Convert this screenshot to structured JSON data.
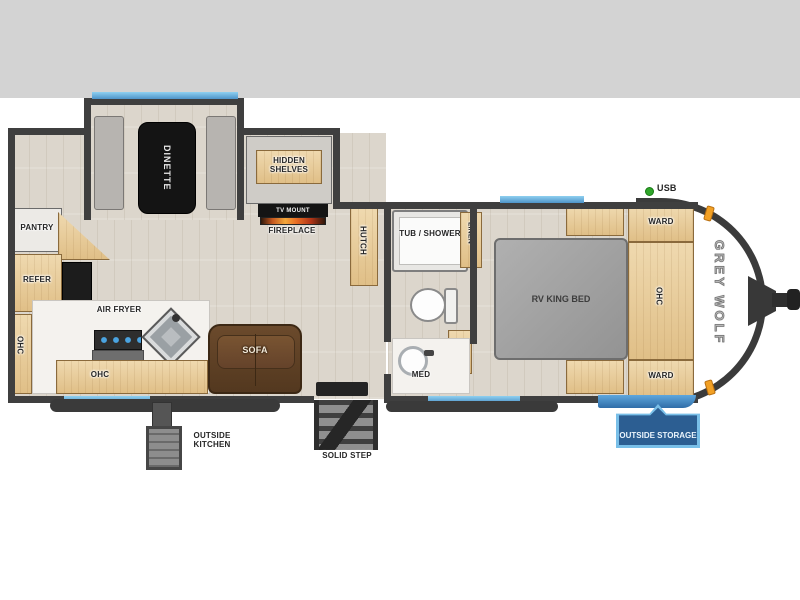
{
  "scene": {
    "type": "travel-trailer-floorplan",
    "brand": "GREY WOLF"
  },
  "labels": {
    "pantry": "PANTRY",
    "refer": "REFER",
    "ohc_left": "OHC",
    "air_fryer": "AIR FRYER",
    "ohc_counter": "OHC",
    "sofa": "SOFA",
    "dinette": "DINETTE",
    "hidden_shelves": "HIDDEN SHELVES",
    "tv_mount": "TV MOUNT",
    "fireplace": "FIREPLACE",
    "hutch": "HUTCH",
    "tub_shower": "TUB / SHOWER",
    "linen": "LINEN",
    "med": "MED",
    "rv_king_bed": "RV KING BED",
    "ward_top": "WARD",
    "ohc_bedroom": "OHC",
    "ward_bottom": "WARD",
    "usb": "USB",
    "brand": "GREY WOLF",
    "outside_kitchen": "OUTSIDE KITCHEN",
    "solid_step": "SOLID STEP",
    "outside_storage": "OUTSIDE STORAGE"
  },
  "colors": {
    "background_band": "#d3d3d3",
    "wall": "#3f3f3f",
    "accent_blue": "#74b9e4",
    "cabinet_wood": "#e8cf9f",
    "sofa_brown": "#5d4127",
    "bed_gray": "#a6a6a6",
    "badge_blue": "#2c5e92",
    "badge_border": "#79bfe8",
    "usb_green": "#2fa52a",
    "marker_orange": "#f2a024"
  }
}
